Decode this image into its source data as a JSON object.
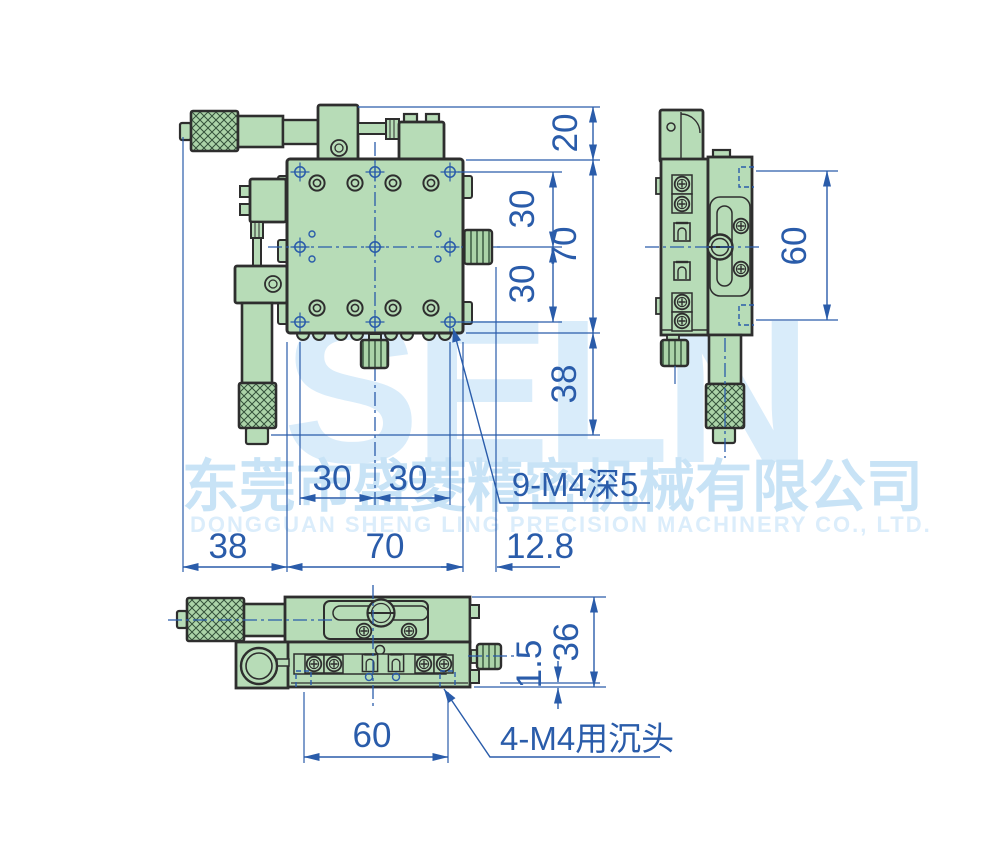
{
  "watermark": {
    "logo": "SELN",
    "company_cn": "东莞市盛菱精密机械有限公司",
    "company_en": "DONGGUAN SHENG LING PRECISION MACHINERY CO., LTD."
  },
  "dimensions": {
    "right_column": {
      "bracket_offset": "20",
      "hole_pitch_upper": "30",
      "plate_height": "70",
      "hole_pitch_lower": "30",
      "micrometer_clearance": "38"
    },
    "bottom_row": {
      "hole_pitch_left": "30",
      "hole_pitch_right": "30",
      "micrometer_length": "38",
      "plate_width": "70",
      "knob_overhang": "12.8"
    },
    "top_view_callout": "9-M4深5",
    "side_view": {
      "mount_pitch": "60"
    },
    "front_view": {
      "overall_height": "36",
      "base_lip": "1.5",
      "hole_span": "60",
      "callout": "4-M4用沉头"
    }
  },
  "colors": {
    "body_green": "#b7dcb7",
    "knurl_green": "#abd3a8",
    "outline": "#2e2e2e",
    "dimension_blue": "#2a5caa",
    "watermark_logo": "#d9ecfa",
    "watermark_text": "#c8e3f6"
  }
}
